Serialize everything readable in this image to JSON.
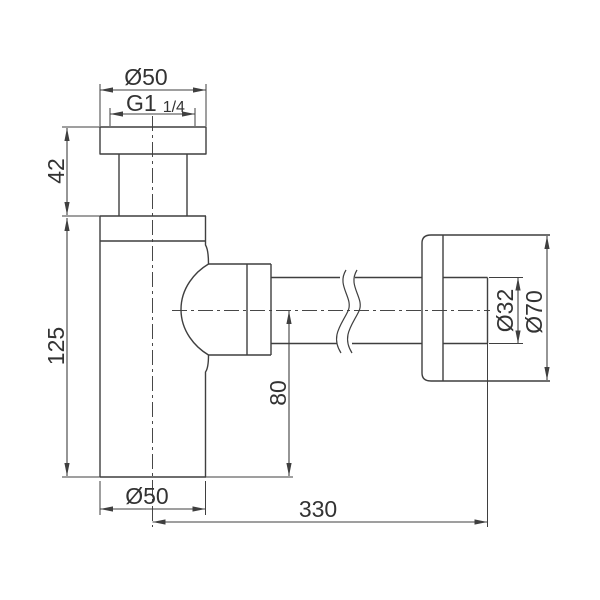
{
  "drawing": {
    "kind": "technical-dimension-drawing",
    "component": "bottle-trap-siphon",
    "dimensions": {
      "top_nut_diameter": "Ø50",
      "thread_main": "G1",
      "thread_fraction": "1/4",
      "inlet_height": "42",
      "body_height": "125",
      "body_diameter": "Ø50",
      "horizontal_length": "330",
      "outlet_center_height": "80",
      "pipe_diameter": "Ø32",
      "wall_flange_diameter": "Ø70"
    },
    "colors": {
      "line": "#3f3f3f",
      "text": "#333333",
      "background": "#ffffff"
    }
  }
}
